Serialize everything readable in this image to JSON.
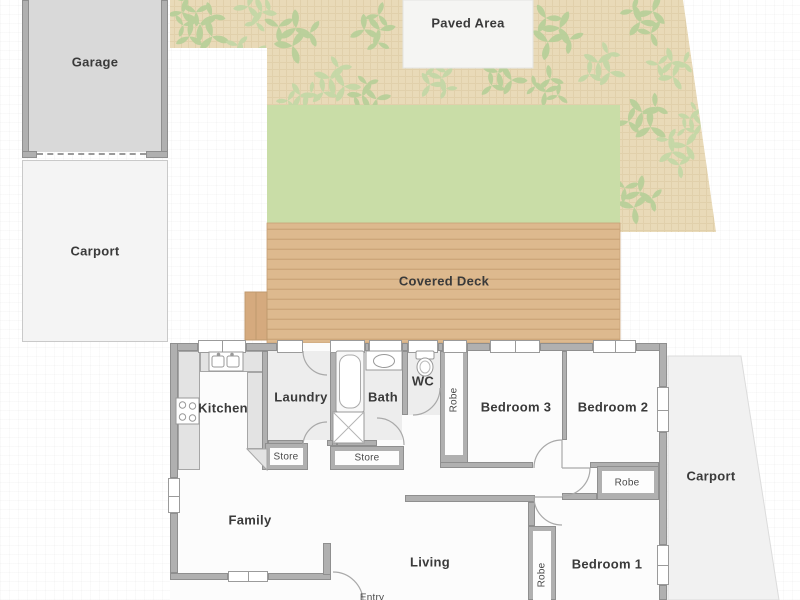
{
  "plan": {
    "outdoor": {
      "garage": "Garage",
      "carport_left": "Carport",
      "paved_area": "Paved Area",
      "covered_deck": "Covered Deck",
      "carport_right": "Carport"
    },
    "rooms": {
      "kitchen": "Kitchen",
      "laundry": "Laundry",
      "bath": "Bath",
      "wc": "WC",
      "bedroom3": "Bedroom 3",
      "bedroom2": "Bedroom 2",
      "bedroom1": "Bedroom 1",
      "family": "Family",
      "living": "Living",
      "entry": "Entry"
    },
    "closets": {
      "robe": "Robe",
      "store": "Store"
    },
    "colors": {
      "garden": "#e9dab8",
      "leaf": "#b6cf98",
      "lawn": "#c9dda7",
      "deck": "#ddb98e",
      "deck_stripe": "#cda67a",
      "wall": "#b0b0b0",
      "garage_fill": "#d9d9d9",
      "carport_fill": "#f3f3f3",
      "wet_room_fill": "#ededed",
      "label_color": "#3a3a3a"
    }
  }
}
